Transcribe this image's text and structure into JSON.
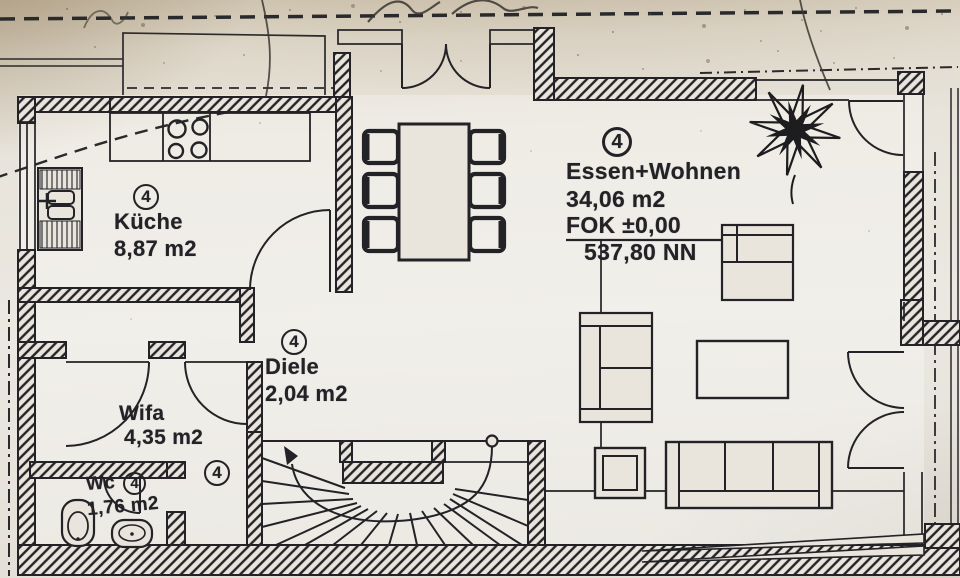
{
  "plan": {
    "type": "floor-plan-scan",
    "rooms": [
      {
        "id": "kueche",
        "marker": "4",
        "name": "Küche",
        "area": "8,87 m2"
      },
      {
        "id": "diele",
        "marker": "4",
        "name": "Diele",
        "area": "2,04 m2"
      },
      {
        "id": "essen-wohnen",
        "marker": "4",
        "name": "Essen+Wohnen",
        "area": "34,06 m2",
        "floor_level": "FOK ±0,00",
        "elevation": "537,80 NN"
      },
      {
        "id": "wifa",
        "marker": "4",
        "name": "Wifa",
        "area": "4,35 m2"
      },
      {
        "id": "wc",
        "marker": "4",
        "name": "Wc",
        "area": "1,76 m2"
      }
    ],
    "colors": {
      "ink": "#232226",
      "paper": "#e8e4dc",
      "paper_shadow": "#cfc4af"
    }
  }
}
